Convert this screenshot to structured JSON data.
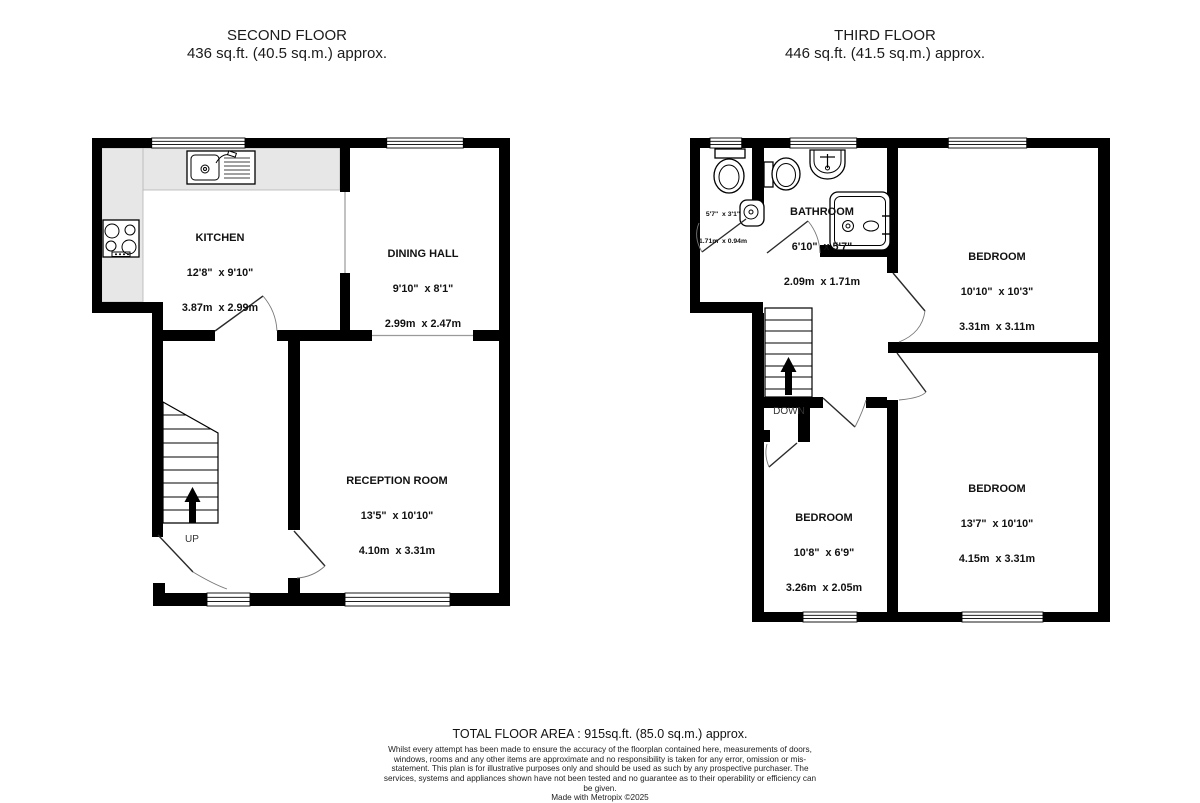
{
  "second_floor": {
    "title": "SECOND FLOOR",
    "area": "436 sq.ft. (40.5 sq.m.) approx.",
    "rooms": {
      "kitchen": {
        "name": "KITCHEN",
        "imperial": "12'8\"  x 9'10\"",
        "metric": "3.87m  x 2.99m"
      },
      "dining": {
        "name": "DINING HALL",
        "imperial": "9'10\"  x 8'1\"",
        "metric": "2.99m  x 2.47m"
      },
      "reception": {
        "name": "RECEPTION ROOM",
        "imperial": "13'5\"  x 10'10\"",
        "metric": "4.10m  x 3.31m"
      }
    },
    "stair_label": "UP"
  },
  "third_floor": {
    "title": "THIRD FLOOR",
    "area": "446 sq.ft. (41.5 sq.m.) approx.",
    "rooms": {
      "bathroom": {
        "name": "BATHROOM",
        "imperial": "6'10\"  x 5'7\"",
        "metric": "2.09m  x 1.71m"
      },
      "bedroom_top": {
        "name": "BEDROOM",
        "imperial": "10'10\"  x 10'3\"",
        "metric": "3.31m  x 3.11m"
      },
      "bedroom_right": {
        "name": "BEDROOM",
        "imperial": "13'7\"  x 10'10\"",
        "metric": "4.15m  x 3.31m"
      },
      "bedroom_left": {
        "name": "BEDROOM",
        "imperial": "10'8\"  x 6'9\"",
        "metric": "3.26m  x 2.05m"
      },
      "wc": {
        "imperial": "5'7\"  x 3'1\"",
        "metric": "1.71m  x 0.94m"
      }
    },
    "stair_label": "DOWN"
  },
  "footer": {
    "total": "TOTAL FLOOR AREA : 915sq.ft. (85.0 sq.m.) approx.",
    "disclaimer": "Whilst every attempt has been made to ensure the accuracy of the floorplan contained here, measurements of doors, windows, rooms and any other items are approximate and no responsibility is taken for any error, omission or mis-statement. This plan is for illustrative purposes only and should be used as such by any prospective purchaser. The services, systems and appliances shown have not been tested and no guarantee as to their operability or efficiency can be given.",
    "credit": "Made with Metropix ©2025"
  }
}
